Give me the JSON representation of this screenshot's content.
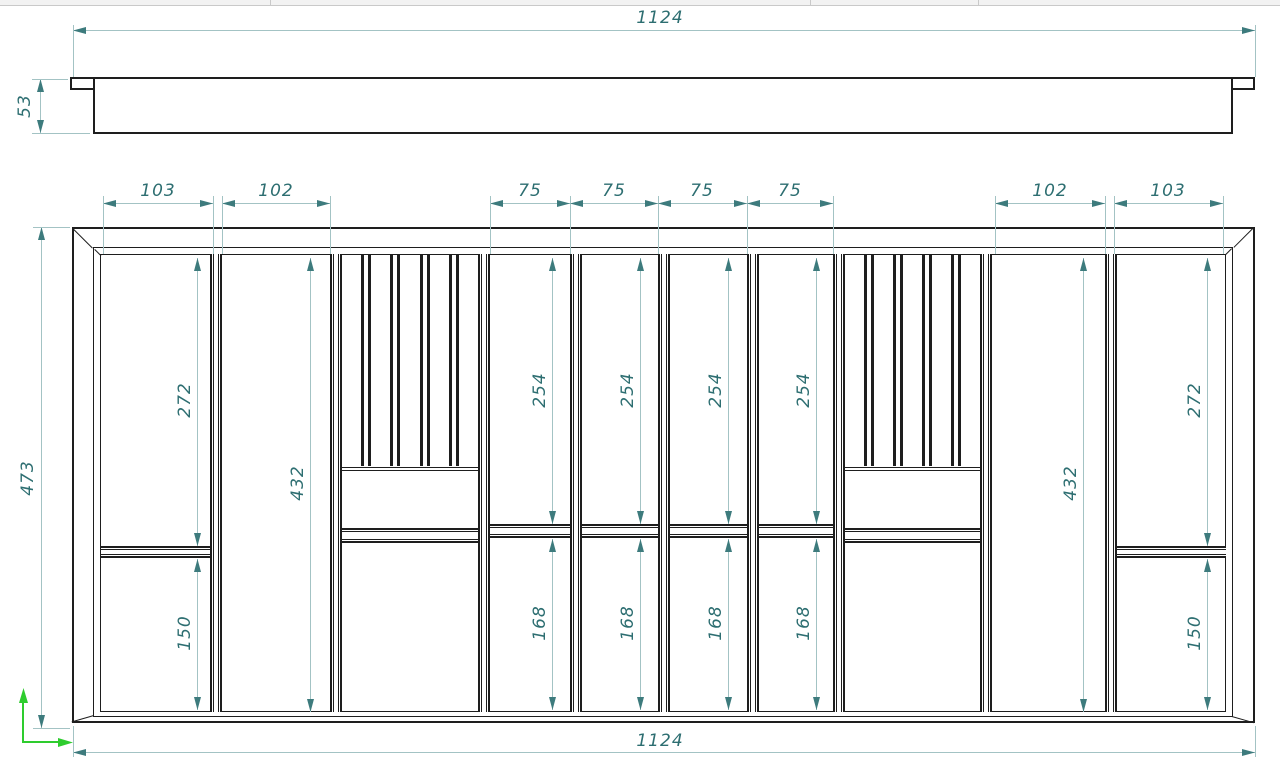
{
  "colors": {
    "drawing_line": "#1e1e1e",
    "dimension_line": "#a3c3c4",
    "dimension_text": "#2d6e71",
    "axis_green": "#2ecc2e",
    "toolbar_bg": "#f2f2f2"
  },
  "icons": {
    "ucs": "xy-axes-icon"
  },
  "side_view": {
    "width": "1124",
    "height": "53"
  },
  "plan_view": {
    "height_left": "473",
    "width_bottom": "1124",
    "top_dims": [
      "103",
      "102",
      "75",
      "75",
      "75",
      "75",
      "102",
      "103"
    ],
    "upper_compartment_dims": [
      "272",
      "432",
      "254",
      "254",
      "254",
      "254",
      "432",
      "272"
    ],
    "lower_compartment_dims": [
      "150",
      "168",
      "168",
      "168",
      "168",
      "150"
    ]
  }
}
